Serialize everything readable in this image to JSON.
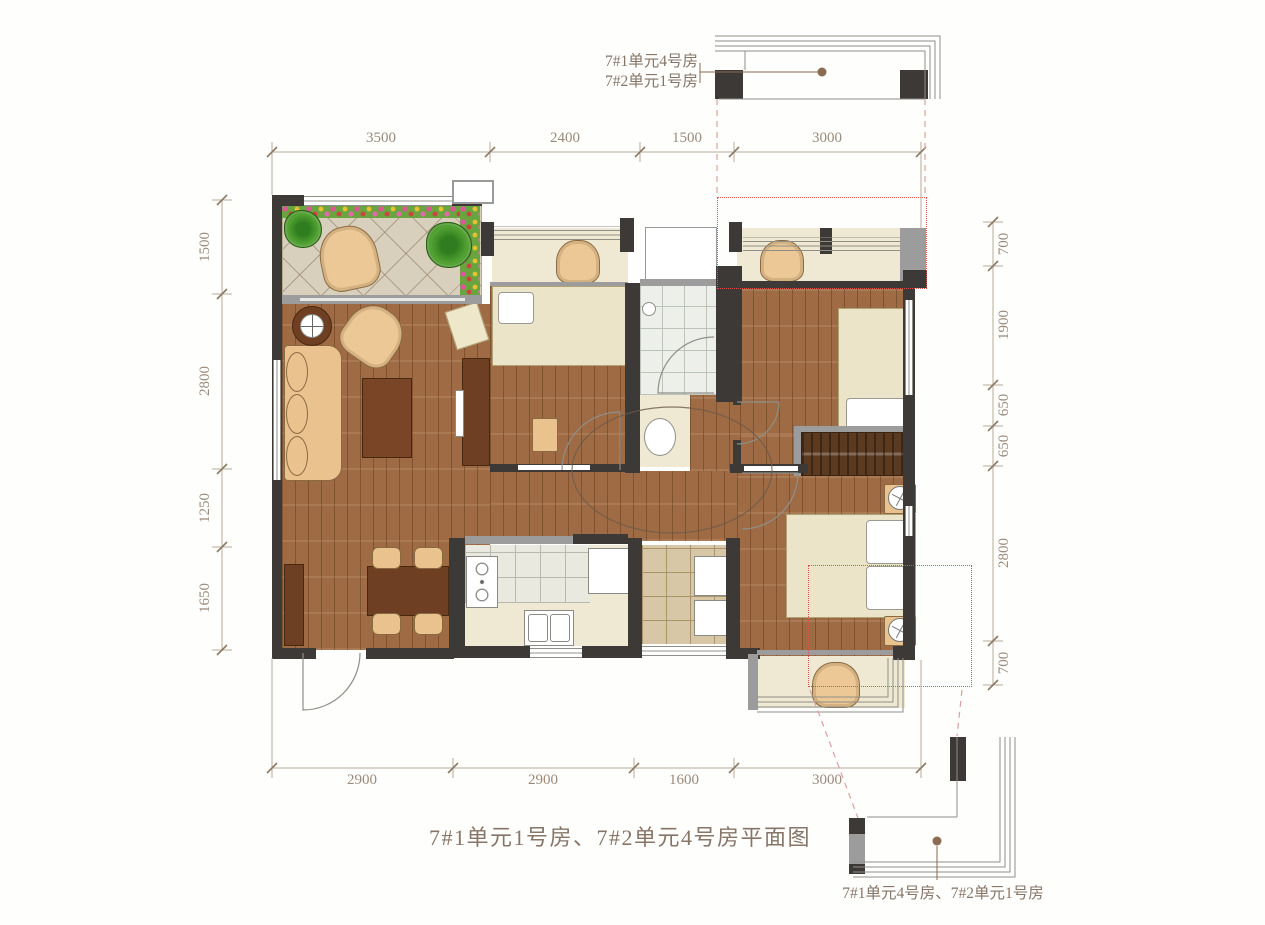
{
  "caption": {
    "text": "7#1单元1号房、7#2单元4号房平面图"
  },
  "top_detail": {
    "label_line1": "7#1单元4号房",
    "label_line2": "7#2单元1号房"
  },
  "bottom_detail": {
    "label": "7#1单元4号房、7#2单元1号房"
  },
  "dimensions": {
    "top": [
      "3500",
      "2400",
      "1500",
      "3000"
    ],
    "bottom": [
      "2900",
      "2900",
      "1600",
      "3000"
    ],
    "left": [
      "1500",
      "2800",
      "1250",
      "1650"
    ],
    "right": [
      "700",
      "1900",
      "650",
      "650",
      "2800",
      "700"
    ]
  },
  "colors": {
    "wall": "#3d3936",
    "window_wall": "#9c9c9c",
    "wood_floor": "#9e6b45",
    "dark_wood_furniture": "#6e3f22",
    "bed_cream": "#ece4c8",
    "dimension_text": "#9a8a7a",
    "red_dotted_overlay": "#e05050",
    "leader_dot": "#8b6b52"
  }
}
